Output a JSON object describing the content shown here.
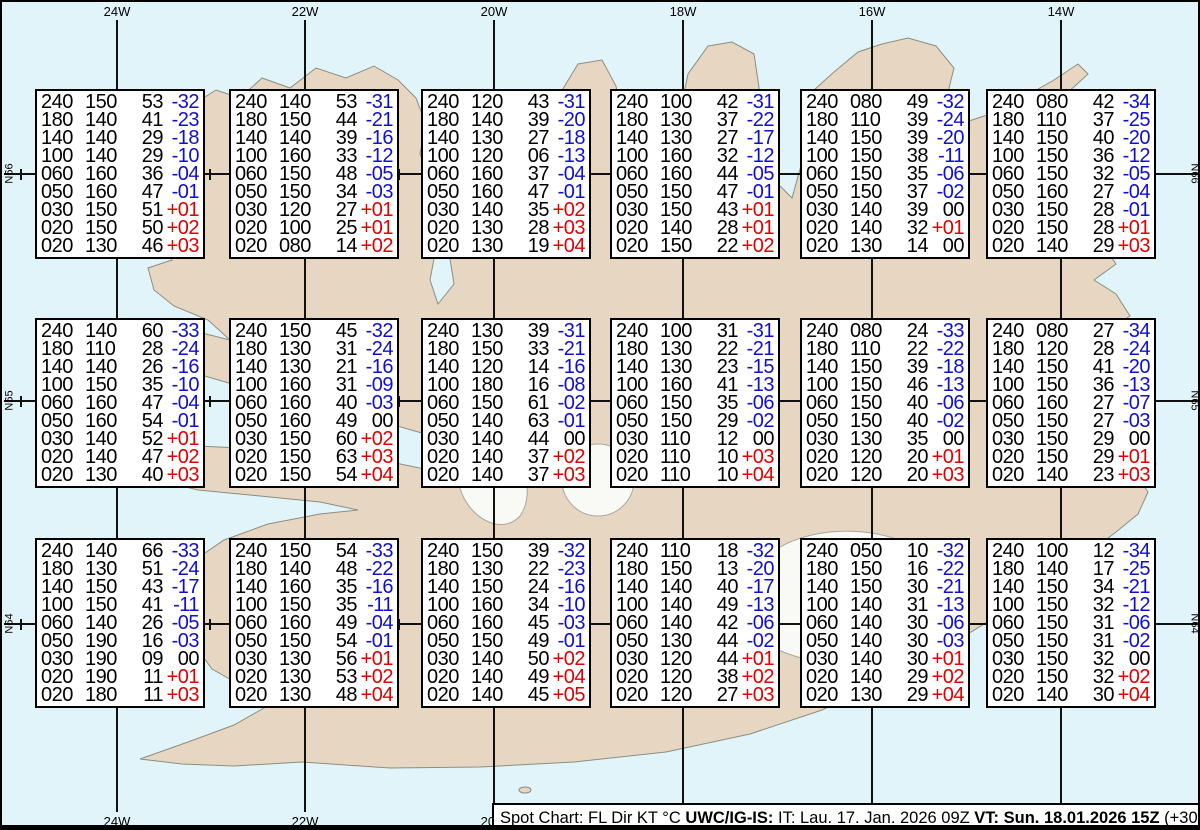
{
  "map": {
    "longitude_labels": [
      "24W",
      "22W",
      "20W",
      "18W",
      "16W",
      "14W"
    ],
    "latitude_labels": [
      "N66",
      "N65",
      "N64"
    ]
  },
  "columns": [
    "FL",
    "Dir",
    "KT",
    "°C"
  ],
  "colors": {
    "sea": "#e1f4f9",
    "land": "#e7d7c2",
    "coast": "#8d8d80",
    "glacier": "#f9f9f5",
    "grid": "#111111",
    "negative_temp": "#0f0fd0",
    "positive_temp": "#e00000",
    "zero_temp": "#000000"
  },
  "caption": {
    "segments": [
      {
        "text": "Spot Chart: FL Dir KT °C ",
        "bold": false
      },
      {
        "text": "UWC/IG-IS:",
        "bold": true
      },
      {
        "text": " IT: Lau. 17. Jan. 2026 09Z ",
        "bold": false
      },
      {
        "text": "VT: Sun. 18.01.2026 15Z",
        "bold": true
      },
      {
        "text": " (+30 h)",
        "bold": false
      }
    ]
  },
  "boxes": [
    [
      [
        "240",
        "150",
        "53",
        "-32"
      ],
      [
        "180",
        "140",
        "41",
        "-23"
      ],
      [
        "140",
        "140",
        "29",
        "-18"
      ],
      [
        "100",
        "140",
        "29",
        "-10"
      ],
      [
        "060",
        "160",
        "36",
        "-04"
      ],
      [
        "050",
        "160",
        "47",
        "-01"
      ],
      [
        "030",
        "150",
        "51",
        "+01"
      ],
      [
        "020",
        "150",
        "50",
        "+02"
      ],
      [
        "020",
        "130",
        "46",
        "+03"
      ]
    ],
    [
      [
        "240",
        "140",
        "53",
        "-31"
      ],
      [
        "180",
        "150",
        "44",
        "-21"
      ],
      [
        "140",
        "140",
        "39",
        "-16"
      ],
      [
        "100",
        "160",
        "33",
        "-12"
      ],
      [
        "060",
        "150",
        "48",
        "-05"
      ],
      [
        "050",
        "150",
        "34",
        "-03"
      ],
      [
        "030",
        "120",
        "27",
        "+01"
      ],
      [
        "020",
        "100",
        "25",
        "+01"
      ],
      [
        "020",
        "080",
        "14",
        "+02"
      ]
    ],
    [
      [
        "240",
        "120",
        "43",
        "-31"
      ],
      [
        "180",
        "140",
        "39",
        "-20"
      ],
      [
        "140",
        "130",
        "27",
        "-18"
      ],
      [
        "100",
        "120",
        "06",
        "-13"
      ],
      [
        "060",
        "160",
        "37",
        "-04"
      ],
      [
        "050",
        "160",
        "47",
        "-01"
      ],
      [
        "030",
        "140",
        "35",
        "+02"
      ],
      [
        "020",
        "130",
        "28",
        "+03"
      ],
      [
        "020",
        "130",
        "19",
        "+04"
      ]
    ],
    [
      [
        "240",
        "100",
        "42",
        "-31"
      ],
      [
        "180",
        "130",
        "37",
        "-22"
      ],
      [
        "140",
        "130",
        "27",
        "-17"
      ],
      [
        "100",
        "160",
        "32",
        "-12"
      ],
      [
        "060",
        "160",
        "44",
        "-05"
      ],
      [
        "050",
        "150",
        "47",
        "-01"
      ],
      [
        "030",
        "150",
        "43",
        "+01"
      ],
      [
        "020",
        "140",
        "28",
        "+01"
      ],
      [
        "020",
        "150",
        "22",
        "+02"
      ]
    ],
    [
      [
        "240",
        "080",
        "49",
        "-32"
      ],
      [
        "180",
        "110",
        "39",
        "-24"
      ],
      [
        "140",
        "150",
        "39",
        "-20"
      ],
      [
        "100",
        "150",
        "38",
        "-11"
      ],
      [
        "060",
        "150",
        "35",
        "-06"
      ],
      [
        "050",
        "150",
        "37",
        "-02"
      ],
      [
        "030",
        "140",
        "39",
        "00"
      ],
      [
        "020",
        "140",
        "32",
        "+01"
      ],
      [
        "020",
        "130",
        "14",
        "00"
      ]
    ],
    [
      [
        "240",
        "080",
        "42",
        "-34"
      ],
      [
        "180",
        "110",
        "37",
        "-25"
      ],
      [
        "140",
        "150",
        "40",
        "-20"
      ],
      [
        "100",
        "150",
        "36",
        "-12"
      ],
      [
        "060",
        "150",
        "32",
        "-05"
      ],
      [
        "050",
        "160",
        "27",
        "-04"
      ],
      [
        "030",
        "150",
        "28",
        "-01"
      ],
      [
        "020",
        "150",
        "28",
        "+01"
      ],
      [
        "020",
        "140",
        "29",
        "+03"
      ]
    ],
    [
      [
        "240",
        "140",
        "60",
        "-33"
      ],
      [
        "180",
        "110",
        "28",
        "-24"
      ],
      [
        "140",
        "140",
        "26",
        "-16"
      ],
      [
        "100",
        "150",
        "35",
        "-10"
      ],
      [
        "060",
        "160",
        "47",
        "-04"
      ],
      [
        "050",
        "160",
        "54",
        "-01"
      ],
      [
        "030",
        "140",
        "52",
        "+01"
      ],
      [
        "020",
        "140",
        "47",
        "+02"
      ],
      [
        "020",
        "130",
        "40",
        "+03"
      ]
    ],
    [
      [
        "240",
        "150",
        "45",
        "-32"
      ],
      [
        "180",
        "130",
        "31",
        "-24"
      ],
      [
        "140",
        "130",
        "21",
        "-16"
      ],
      [
        "100",
        "160",
        "31",
        "-09"
      ],
      [
        "060",
        "160",
        "40",
        "-03"
      ],
      [
        "050",
        "160",
        "49",
        "00"
      ],
      [
        "030",
        "150",
        "60",
        "+02"
      ],
      [
        "020",
        "150",
        "63",
        "+03"
      ],
      [
        "020",
        "150",
        "54",
        "+04"
      ]
    ],
    [
      [
        "240",
        "130",
        "39",
        "-31"
      ],
      [
        "180",
        "150",
        "33",
        "-21"
      ],
      [
        "140",
        "120",
        "14",
        "-16"
      ],
      [
        "100",
        "180",
        "16",
        "-08"
      ],
      [
        "060",
        "150",
        "61",
        "-02"
      ],
      [
        "050",
        "140",
        "63",
        "-01"
      ],
      [
        "030",
        "140",
        "44",
        "00"
      ],
      [
        "020",
        "140",
        "37",
        "+02"
      ],
      [
        "020",
        "140",
        "37",
        "+03"
      ]
    ],
    [
      [
        "240",
        "100",
        "31",
        "-31"
      ],
      [
        "180",
        "130",
        "22",
        "-21"
      ],
      [
        "140",
        "130",
        "23",
        "-15"
      ],
      [
        "100",
        "160",
        "41",
        "-13"
      ],
      [
        "060",
        "150",
        "35",
        "-06"
      ],
      [
        "050",
        "150",
        "29",
        "-02"
      ],
      [
        "030",
        "110",
        "12",
        "00"
      ],
      [
        "020",
        "110",
        "10",
        "+03"
      ],
      [
        "020",
        "110",
        "10",
        "+04"
      ]
    ],
    [
      [
        "240",
        "080",
        "24",
        "-33"
      ],
      [
        "180",
        "110",
        "22",
        "-22"
      ],
      [
        "140",
        "150",
        "39",
        "-18"
      ],
      [
        "100",
        "150",
        "46",
        "-13"
      ],
      [
        "060",
        "150",
        "40",
        "-06"
      ],
      [
        "050",
        "150",
        "40",
        "-02"
      ],
      [
        "030",
        "130",
        "35",
        "00"
      ],
      [
        "020",
        "120",
        "20",
        "+01"
      ],
      [
        "020",
        "120",
        "20",
        "+03"
      ]
    ],
    [
      [
        "240",
        "080",
        "27",
        "-34"
      ],
      [
        "180",
        "120",
        "28",
        "-24"
      ],
      [
        "140",
        "150",
        "41",
        "-20"
      ],
      [
        "100",
        "150",
        "36",
        "-13"
      ],
      [
        "060",
        "160",
        "27",
        "-07"
      ],
      [
        "050",
        "150",
        "27",
        "-03"
      ],
      [
        "030",
        "150",
        "29",
        "00"
      ],
      [
        "020",
        "150",
        "29",
        "+01"
      ],
      [
        "020",
        "140",
        "23",
        "+03"
      ]
    ],
    [
      [
        "240",
        "140",
        "66",
        "-33"
      ],
      [
        "180",
        "130",
        "51",
        "-24"
      ],
      [
        "140",
        "150",
        "43",
        "-17"
      ],
      [
        "100",
        "150",
        "41",
        "-11"
      ],
      [
        "060",
        "140",
        "26",
        "-05"
      ],
      [
        "050",
        "190",
        "16",
        "-03"
      ],
      [
        "030",
        "190",
        "09",
        "00"
      ],
      [
        "020",
        "190",
        "11",
        "+01"
      ],
      [
        "020",
        "180",
        "11",
        "+03"
      ]
    ],
    [
      [
        "240",
        "150",
        "54",
        "-33"
      ],
      [
        "180",
        "140",
        "48",
        "-22"
      ],
      [
        "140",
        "160",
        "35",
        "-16"
      ],
      [
        "100",
        "150",
        "35",
        "-11"
      ],
      [
        "060",
        "160",
        "49",
        "-04"
      ],
      [
        "050",
        "150",
        "54",
        "-01"
      ],
      [
        "030",
        "130",
        "56",
        "+01"
      ],
      [
        "020",
        "130",
        "53",
        "+02"
      ],
      [
        "020",
        "130",
        "48",
        "+04"
      ]
    ],
    [
      [
        "240",
        "150",
        "39",
        "-32"
      ],
      [
        "180",
        "130",
        "22",
        "-23"
      ],
      [
        "140",
        "150",
        "24",
        "-16"
      ],
      [
        "100",
        "160",
        "34",
        "-10"
      ],
      [
        "060",
        "160",
        "45",
        "-03"
      ],
      [
        "050",
        "150",
        "49",
        "-01"
      ],
      [
        "030",
        "140",
        "50",
        "+02"
      ],
      [
        "020",
        "140",
        "49",
        "+04"
      ],
      [
        "020",
        "140",
        "45",
        "+05"
      ]
    ],
    [
      [
        "240",
        "110",
        "18",
        "-32"
      ],
      [
        "180",
        "150",
        "13",
        "-20"
      ],
      [
        "140",
        "140",
        "40",
        "-17"
      ],
      [
        "100",
        "140",
        "49",
        "-13"
      ],
      [
        "060",
        "140",
        "42",
        "-06"
      ],
      [
        "050",
        "130",
        "44",
        "-02"
      ],
      [
        "030",
        "120",
        "44",
        "+01"
      ],
      [
        "020",
        "120",
        "38",
        "+02"
      ],
      [
        "020",
        "120",
        "27",
        "+03"
      ]
    ],
    [
      [
        "240",
        "050",
        "10",
        "-32"
      ],
      [
        "180",
        "150",
        "16",
        "-22"
      ],
      [
        "140",
        "150",
        "30",
        "-21"
      ],
      [
        "100",
        "140",
        "31",
        "-13"
      ],
      [
        "060",
        "140",
        "30",
        "-06"
      ],
      [
        "050",
        "140",
        "30",
        "-03"
      ],
      [
        "030",
        "140",
        "30",
        "+01"
      ],
      [
        "020",
        "140",
        "29",
        "+02"
      ],
      [
        "020",
        "130",
        "29",
        "+04"
      ]
    ],
    [
      [
        "240",
        "100",
        "12",
        "-34"
      ],
      [
        "180",
        "140",
        "17",
        "-25"
      ],
      [
        "140",
        "150",
        "34",
        "-21"
      ],
      [
        "100",
        "150",
        "32",
        "-12"
      ],
      [
        "060",
        "150",
        "31",
        "-06"
      ],
      [
        "050",
        "150",
        "31",
        "-02"
      ],
      [
        "030",
        "150",
        "32",
        "00"
      ],
      [
        "020",
        "150",
        "32",
        "+02"
      ],
      [
        "020",
        "140",
        "30",
        "+04"
      ]
    ]
  ]
}
